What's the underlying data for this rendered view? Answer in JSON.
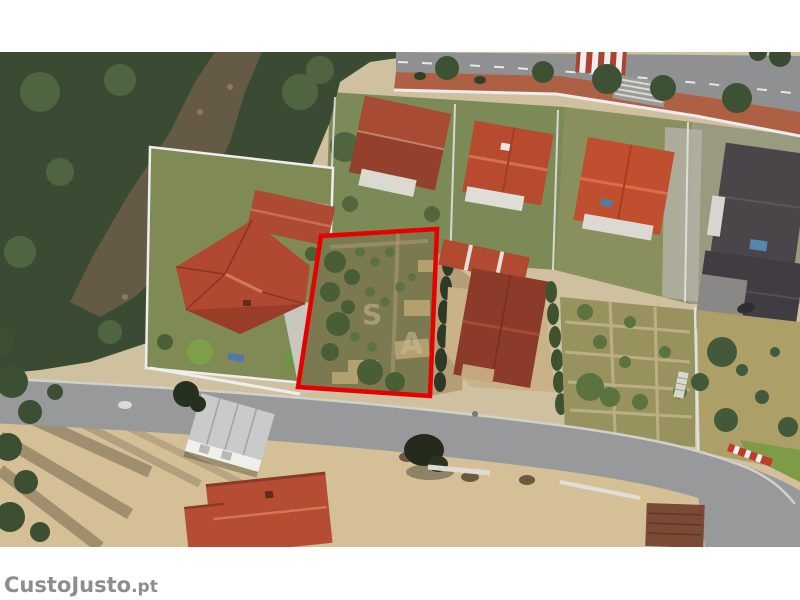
{
  "page": {
    "description": "Aerial satellite photograph of a residential neighborhood with a vegetable-garden building plot outlined in red (property listing image)"
  },
  "watermark": {
    "brand": "CustoJusto",
    "suffix": ".pt"
  },
  "plot_letters": [
    "S",
    "A"
  ],
  "colors": {
    "plot_outline": "#e80000",
    "watermark_gray": "#8d8d8d",
    "letterbox_white": "#ffffff",
    "asphalt_gray": "#98999a",
    "sidewalk_brick": "#ad6043",
    "roof_orange_red": "#b84b2f",
    "roof_dark_red": "#8c3b2a",
    "roof_dark_gray": "#46424a",
    "forest_green": "#3a4a33",
    "garden_green": "#5c7340",
    "sand_tan": "#d4bf97",
    "lawn_green": "#7c8a57"
  }
}
